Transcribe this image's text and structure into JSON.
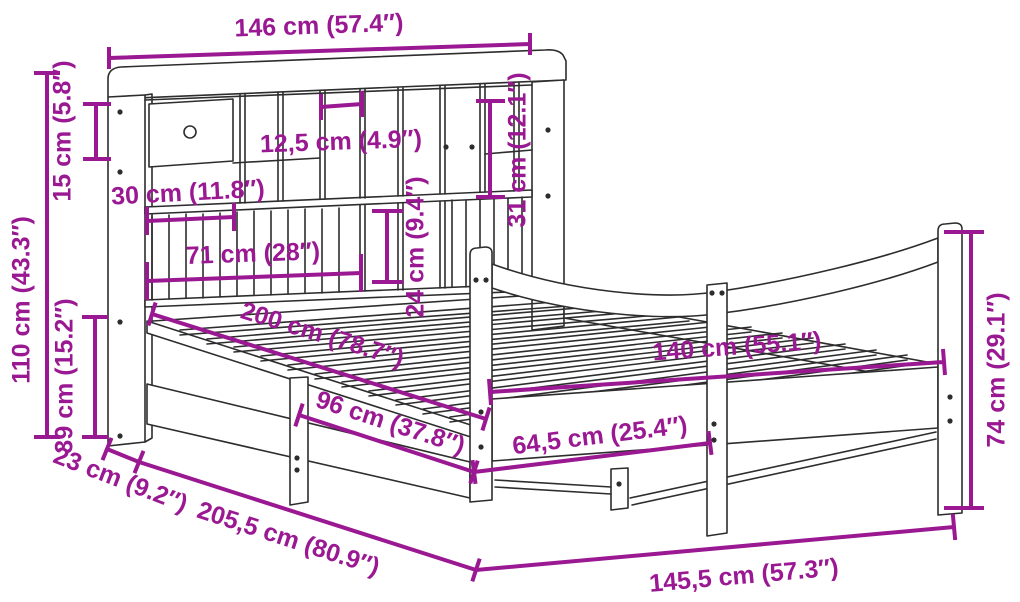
{
  "meta": {
    "description": "Dimension diagram of a bookshelf bed frame with drawer, slatted base and curved footboard",
    "units": "cm and inches"
  },
  "colors": {
    "dimension": "#9a1892",
    "drawing": "#2d2d2d",
    "background": "#ffffff"
  },
  "dimensions": {
    "headboard_total_width": "146 cm (57.4″)",
    "top_shelf_height": "15 cm (5.8″)",
    "headboard_height": "110 cm (43.3″)",
    "base_height": "39 cm (15.2″)",
    "compartment_width": "12,5 cm (4.9″)",
    "drawer_width": "30 cm (11.8″)",
    "rail_section_width": "71 cm (28″)",
    "compartment_height": "31 cm (12.1″)",
    "lower_compartment_height": "24 cm (9.4″)",
    "mattress_length": "200 cm (78.7″)",
    "mattress_width": "140 cm (55.1″)",
    "side_section_length": "96 cm (37.8″)",
    "foot_section_length": "64,5 cm (25.4″)",
    "footboard_height": "74 cm (29.1″)",
    "headboard_depth": "23 cm (9.2″)",
    "total_length": "205,5 cm (80.9″)",
    "total_width": "145,5 cm (57.3″)"
  }
}
